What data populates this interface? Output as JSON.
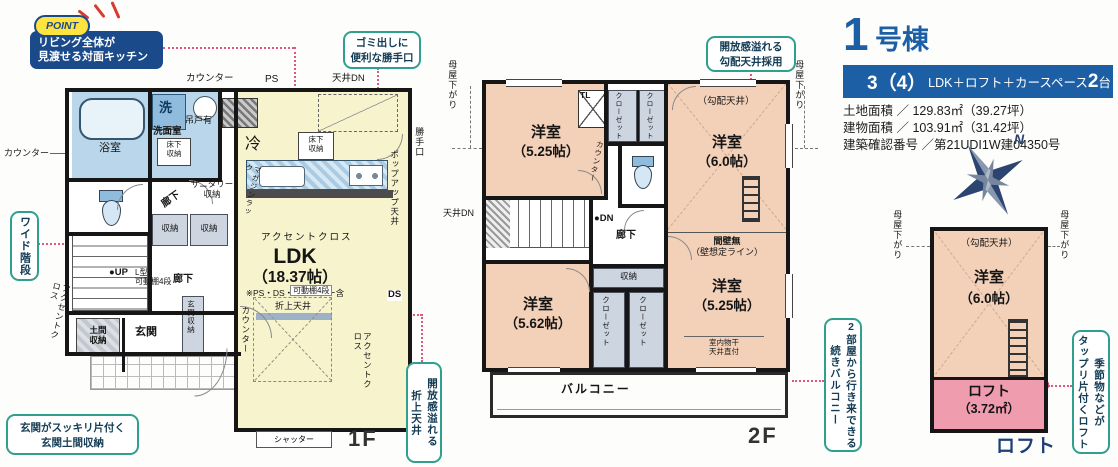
{
  "header": {
    "num": "1",
    "suffix": "号棟",
    "banner_a": "3（4）",
    "banner_b": "LDK＋ロフト＋カースペース",
    "banner_c": "2",
    "banner_d": "台",
    "lines": [
      "土地面積 ／ 129.83㎡（39.27坪）",
      "建物面積 ／ 103.91㎡（31.42坪）",
      "建築確認番号 ／第21UDI1W建04350号"
    ]
  },
  "point": {
    "badge": "POINT",
    "text": "リビング全体が\n見渡せる対面キッチン"
  },
  "callouts": {
    "back_door": "ゴミ出しに\n便利な勝手口",
    "wide_stairs": "ワイド階段",
    "doma": "玄関がスッキリ片付く\n玄関土間収納",
    "oriage": "開放感溢れる\n折上天井",
    "slope": "開放感溢れる\n勾配天井採用",
    "balcony": "2部屋から行き来できる\n続きバルコニー",
    "loft": "季節物などが\nタップリ片付くロフト"
  },
  "f1": {
    "label": "1F",
    "counter_top": "カウンター",
    "ps": "PS",
    "ceiling_dn": "天井DN",
    "counter_left": "カウンター",
    "bath": "浴室",
    "wash": "洗",
    "washroom": "洗面室",
    "hanging": "吊戸有",
    "underfloor1": "床下\n収納",
    "sanitary": "サニタリー\n収納",
    "hall1": "廊下",
    "hall2": "廊下",
    "fridge": "冷",
    "underfloor2": "床下\n収納",
    "magazine": "マガジンラック",
    "accent1": "アクセントクロス",
    "accent2": "アクセントクロス",
    "accent3": "アクセントクロス",
    "ldk": "LDK",
    "ldk_size": "（18.37帖）",
    "ldk_note": "※PS・DS・カウンター含",
    "st1": "収納",
    "st2": "収納",
    "up": "●UP",
    "lshelf": "L型\n可動棚4段",
    "shelf": "可動棚4段",
    "oriage": "折上天井",
    "counter_v": "カウンター",
    "ds": "DS",
    "popup": "ポップアップ天井",
    "backdoor": "勝手口",
    "doma": "土間\n収納",
    "genkan": "玄関",
    "genkan_st": "玄関収納",
    "shutter": "シャッター"
  },
  "f2": {
    "label": "2F",
    "moya_l": "母屋下がり",
    "moya_r": "母屋下がり",
    "r1": "洋室",
    "r1s": "（5.25帖）",
    "tl": "TL",
    "c1": "クローゼット",
    "c2": "クローゼット",
    "c3": "クローゼット",
    "c4": "クローゼット",
    "slope": "（勾配天井）",
    "r2": "洋室",
    "r2s": "（6.0帖）",
    "counter": "カウンター",
    "ceiling_dn": "天井DN",
    "dn": "●DN",
    "hall": "廊下",
    "st": "収納",
    "r3": "洋室",
    "r3s": "（5.62帖）",
    "wn1": "間壁無",
    "wn2": "（壁想定ライン）",
    "r4": "洋室",
    "r4s": "（5.25帖）",
    "laundry": "室内物干\n天井直付",
    "balcony": "バルコニー"
  },
  "loft": {
    "label": "ロフト",
    "moya_l": "母屋下がり",
    "moya_r": "母屋下がり",
    "slope": "（勾配天井）",
    "room": "洋室",
    "room_size": "（6.0帖）",
    "lname": "ロフト",
    "lsize": "（3.72㎡）"
  },
  "compass": {
    "n": "N"
  },
  "colors": {
    "navy": "#1d5fa5",
    "callout_green": "#2fa08e",
    "leader_pink": "#e0567f",
    "cream": "#f6f3cd",
    "peach": "#f3d0b8",
    "wet_blue": "#b9d6ea",
    "loft_pink": "#ee9cae",
    "point_yellow": "#ffe33e",
    "wall": "#161616"
  }
}
